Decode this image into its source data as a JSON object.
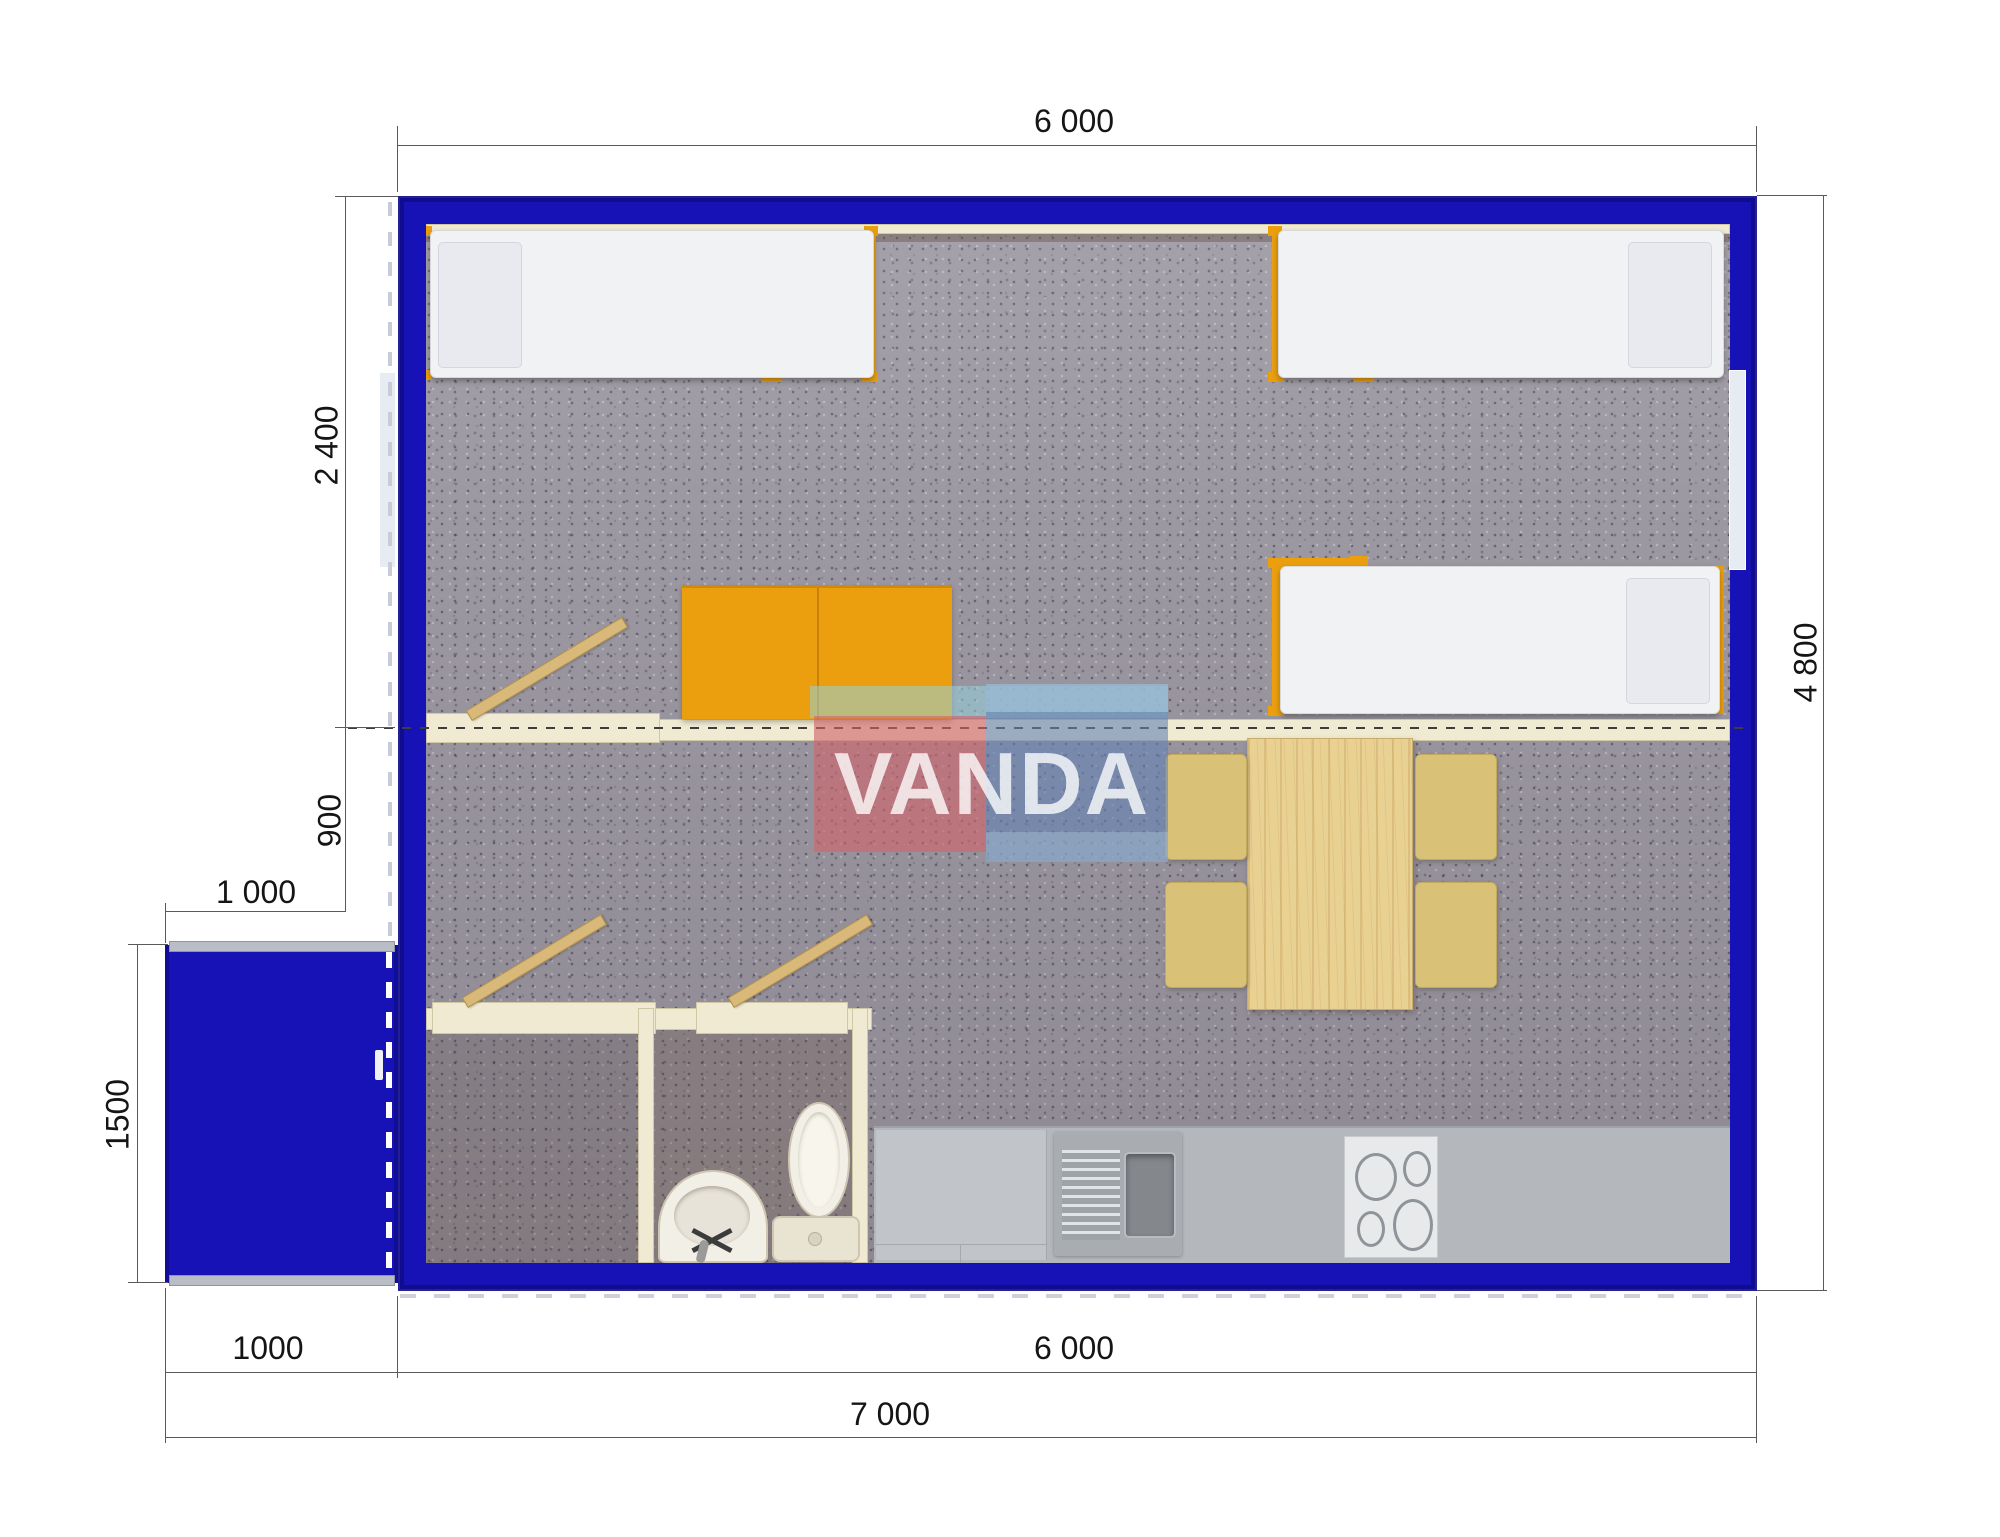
{
  "document": {
    "type": "modular-building-floor-plan"
  },
  "watermark": {
    "brand": "VANDA"
  },
  "dimensions": {
    "top_width": "6 000",
    "right_height": "4 800",
    "left_bedroom_depth": "2 400",
    "left_hall_depth": "900",
    "porch_width_top": "1 000",
    "porch_depth": "1500",
    "bottom_porch_width": "1000",
    "bottom_main_width": "6 000",
    "bottom_total_width": "7 000"
  },
  "colors": {
    "wall_blue": "#1712b6",
    "accent_orange": "#eb9f0e",
    "interior_wall_cream": "#f0ead3",
    "carpet_gray": "#9c98a2",
    "wood_light": "#e9d194",
    "counter_gray": "#b4b7bc",
    "watermark_red": "rgba(208,100,106,0.65)",
    "watermark_blue": "rgba(100,130,180,0.62)",
    "dimension_text": "#151515"
  }
}
